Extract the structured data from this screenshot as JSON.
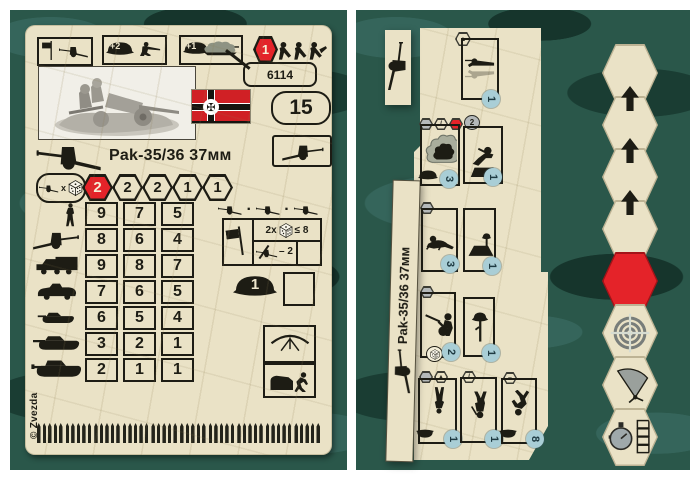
{
  "colors": {
    "camo_base": "#2a574a",
    "camo_light": "#35655b",
    "camo_dark": "#1a3d33",
    "card_cream": "#eae2c6",
    "accent_red": "#e42329",
    "ink_black": "#1d1c14",
    "move_circle_blue": "#a9ced6",
    "badge_gray": "#b4b8b9",
    "photo_bg": "#f1efe8",
    "flag_red": "#d02025"
  },
  "left_card": {
    "product_code": "6114",
    "points_value": "15",
    "unit_title": "Pak-35/36 37мм",
    "top_row": {
      "entrench_bonus": "+2",
      "camouflage_bonus": "+1",
      "move_cost": "1"
    },
    "attack": {
      "multiplier": "x",
      "values": [
        "2",
        "2",
        "2",
        "1",
        "1"
      ]
    },
    "stats_rows": [
      {
        "icon": "infantry",
        "values": [
          "9",
          "7",
          "5"
        ]
      },
      {
        "icon": "anti-tank-gun",
        "values": [
          "8",
          "6",
          "4"
        ]
      },
      {
        "icon": "truck",
        "values": [
          "9",
          "8",
          "7"
        ]
      },
      {
        "icon": "armored-car",
        "values": [
          "7",
          "6",
          "5"
        ]
      },
      {
        "icon": "light-tank",
        "values": [
          "6",
          "5",
          "4"
        ]
      },
      {
        "icon": "medium-tank",
        "values": [
          "3",
          "2",
          "1"
        ]
      },
      {
        "icon": "heavy-tank",
        "values": [
          "2",
          "1",
          "1"
        ]
      }
    ],
    "morale": {
      "roll": "2x",
      "check": "≤ 8",
      "gun_loss": "– 2"
    },
    "helmet_value": "1",
    "copyright": "© Zvezda",
    "ammo": {
      "groups": 10,
      "per_group": 5
    }
  },
  "right_card": {
    "unit_title": "Pak-35/36 37мм",
    "boxes": {
      "ambush": {
        "move": "1"
      },
      "under_fire": {
        "move": "3"
      },
      "assault": {
        "move": "1",
        "timer_badge": "2"
      },
      "crawl": {
        "move": "3"
      },
      "dug_in": {
        "move": "1"
      },
      "firing": {
        "move": "2"
      },
      "casualty": {
        "move": "1"
      },
      "ready": {
        "move": "1"
      },
      "march": {
        "move": "1"
      },
      "rout": {
        "move": "8"
      }
    },
    "badge_glyphs": {
      "terrain": "▲",
      "modifier": "/",
      "minus": "–"
    }
  }
}
